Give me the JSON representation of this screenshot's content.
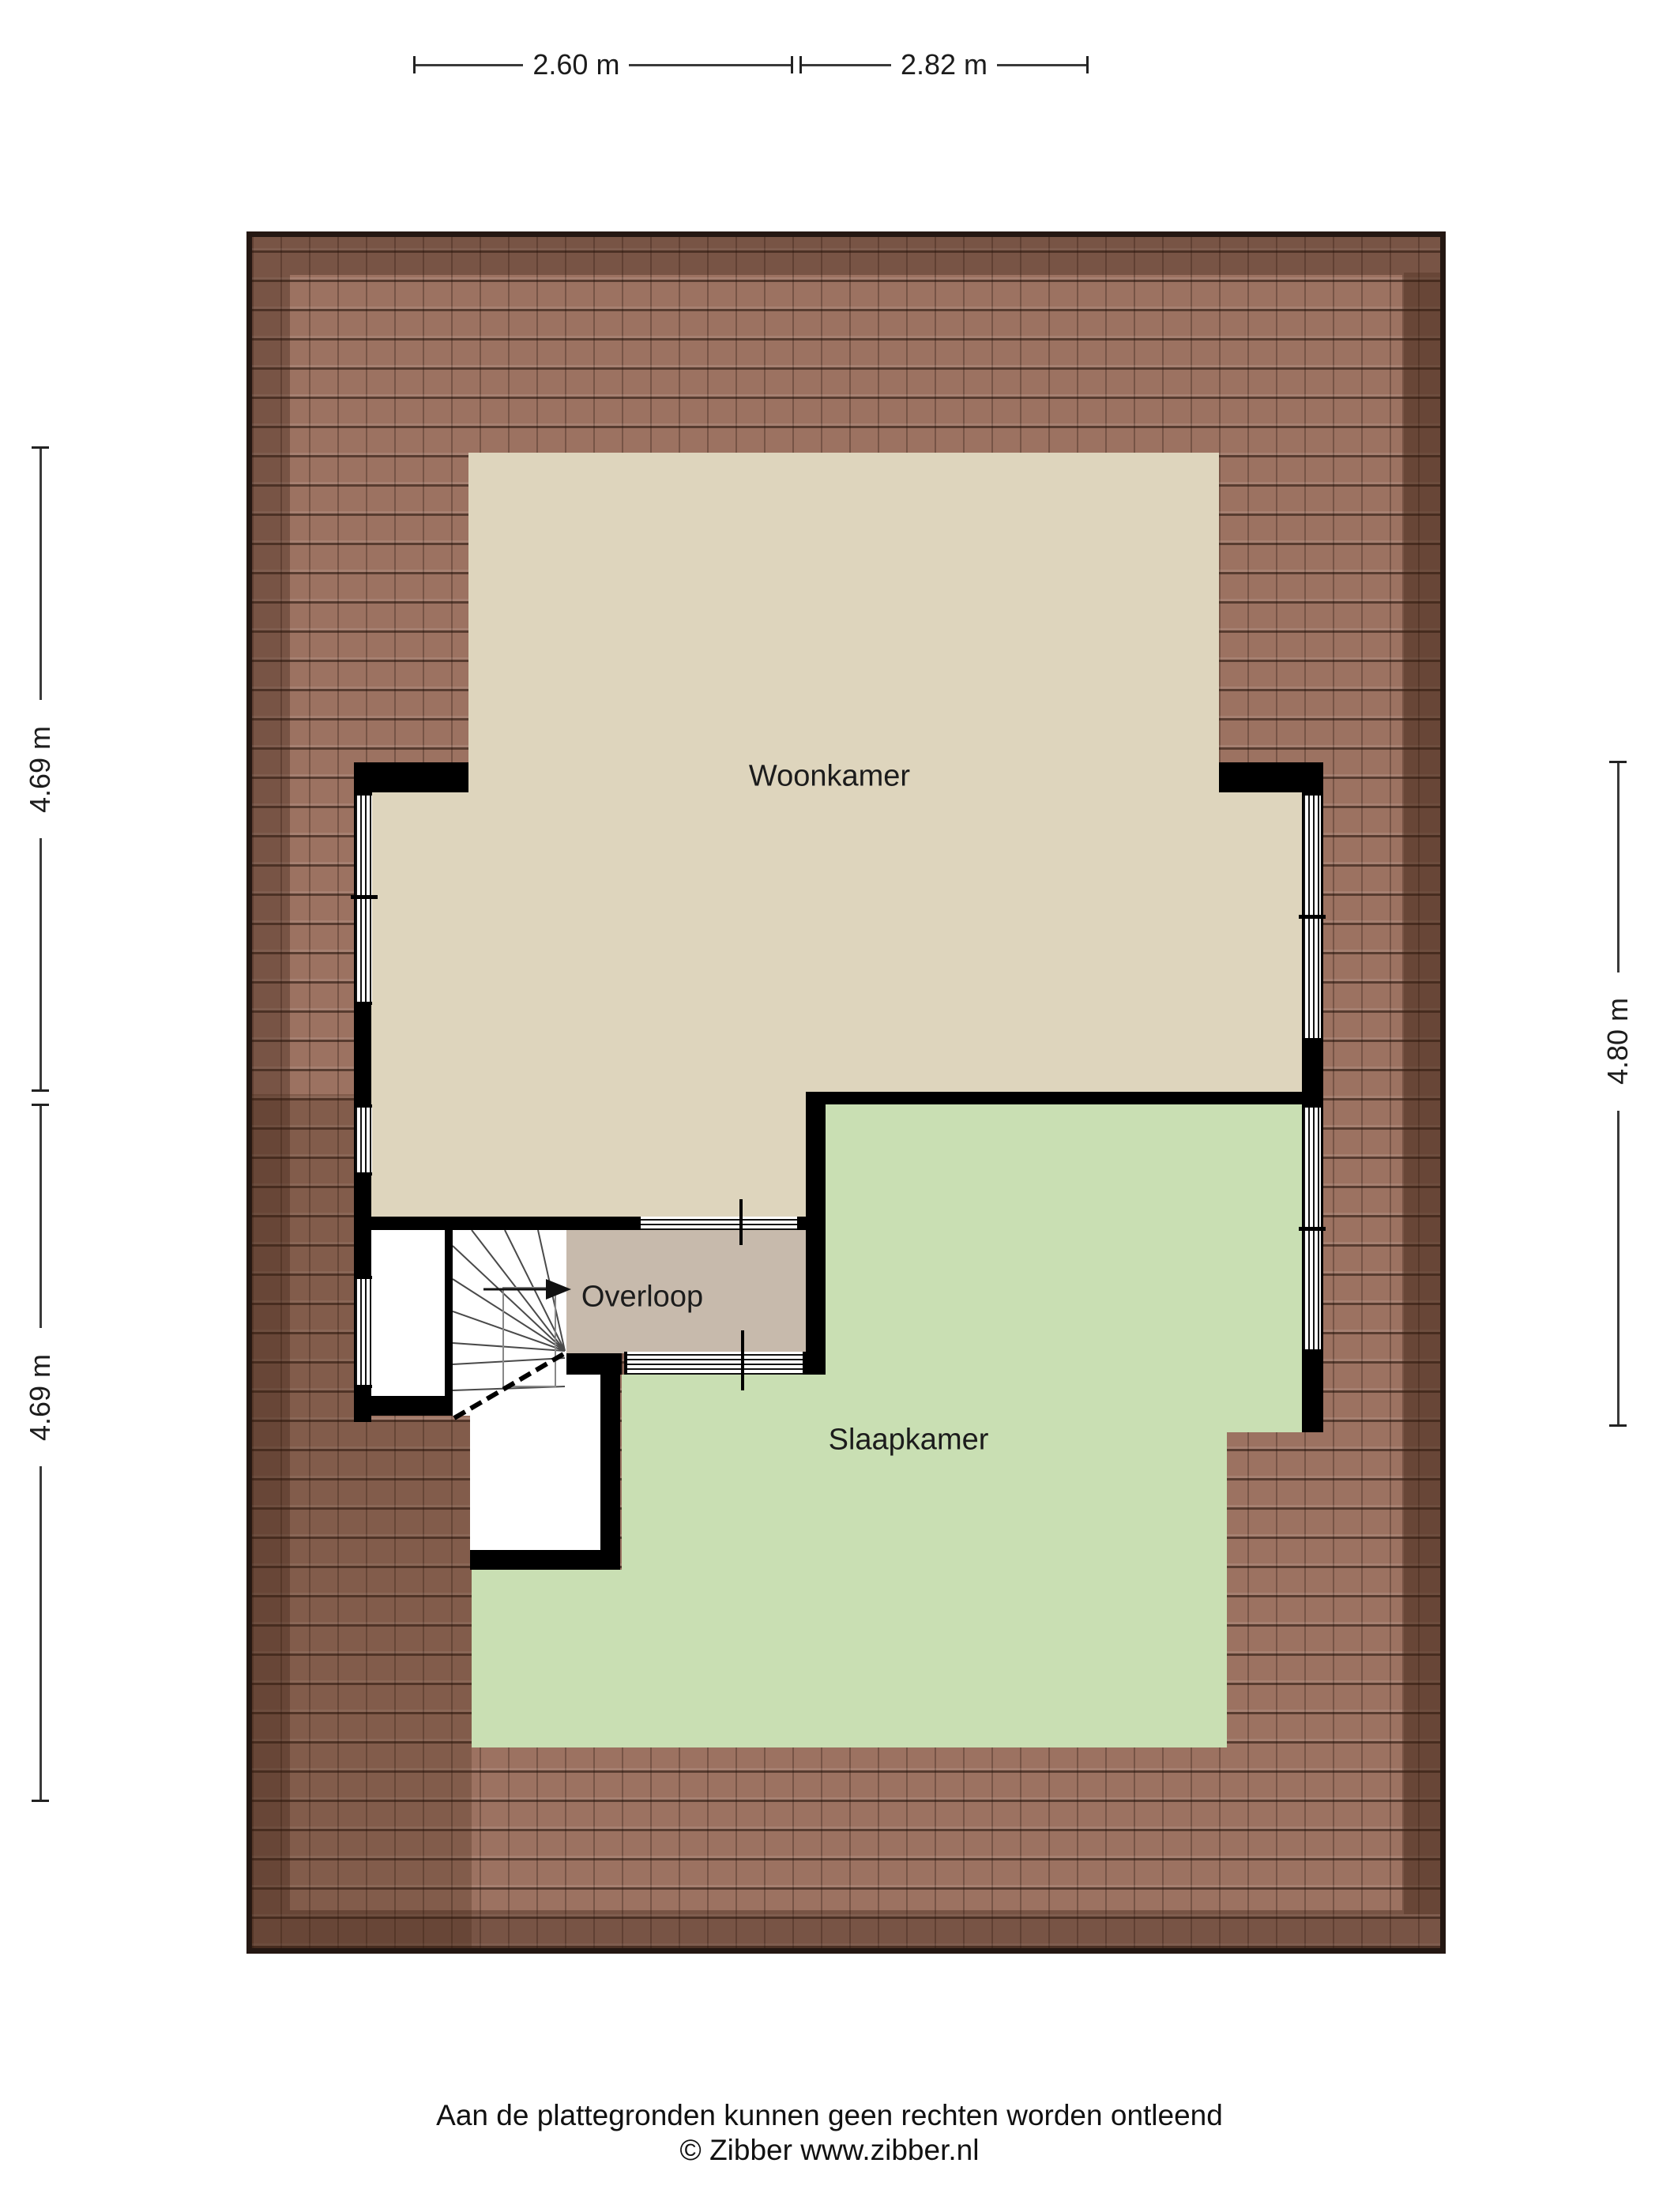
{
  "title": "Plattegrond verdieping",
  "colors": {
    "woonkamer": "#ded5bd",
    "slaapkamer": "#c9dfb3",
    "overloop": "#c7baac",
    "wall": "#000000",
    "roof-base": "#9c7261"
  },
  "rooms": {
    "woonkamer": {
      "label": "Woonkamer"
    },
    "slaapkamer": {
      "label": "Slaapkamer"
    },
    "overloop": {
      "label": "Overloop"
    }
  },
  "dimensions": {
    "top": [
      {
        "label": "2.60 m"
      },
      {
        "label": "2.82 m"
      }
    ],
    "left": [
      {
        "label": "4.69 m"
      },
      {
        "label": "4.69 m"
      }
    ],
    "right": [
      {
        "label": "4.80 m"
      }
    ]
  },
  "icons": {
    "stairs_direction_arrow": "right-arrowhead"
  },
  "footer": {
    "disclaimer": "Aan de plattegronden kunnen geen rechten worden ontleend",
    "copyright": "© Zibber www.zibber.nl"
  }
}
